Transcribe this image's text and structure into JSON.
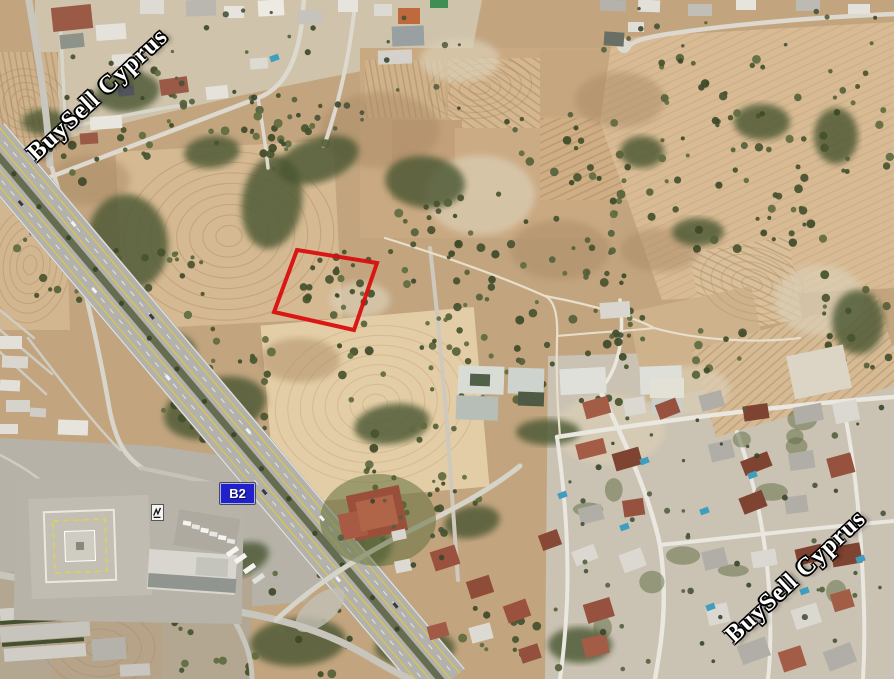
{
  "watermark": {
    "text": "BuySell Cyprus",
    "color": "#ffffff",
    "outline_color": "#000000",
    "instances": [
      {
        "id": "top-left",
        "center_x": 98,
        "center_y": 95,
        "angle_deg": -43
      },
      {
        "id": "bottom-right",
        "center_x": 796,
        "center_y": 577,
        "angle_deg": -43
      }
    ]
  },
  "road_badge": {
    "label": "B2",
    "x": 220,
    "y": 483,
    "width": 33,
    "height": 19,
    "bg_color": "#2121cc",
    "border_color": "#a9b3e6",
    "text_color": "#ffffff"
  },
  "plot_outline": {
    "color": "#d90f0f",
    "stroke_width": 4,
    "points": [
      [
        297,
        250
      ],
      [
        377,
        263
      ],
      [
        354,
        330
      ],
      [
        274,
        312
      ]
    ]
  },
  "palette": {
    "field_tan": "#cfae86",
    "ground_light": "#cdc3ae",
    "asphalt": "#b2b1ab",
    "median_green": "#666c50",
    "tree_green": "#49542f",
    "roof_red": "#96523e",
    "roof_white": "#dad8d0",
    "pool_blue": "#3f9ec0",
    "lane_yellow": "#d9c54e"
  }
}
